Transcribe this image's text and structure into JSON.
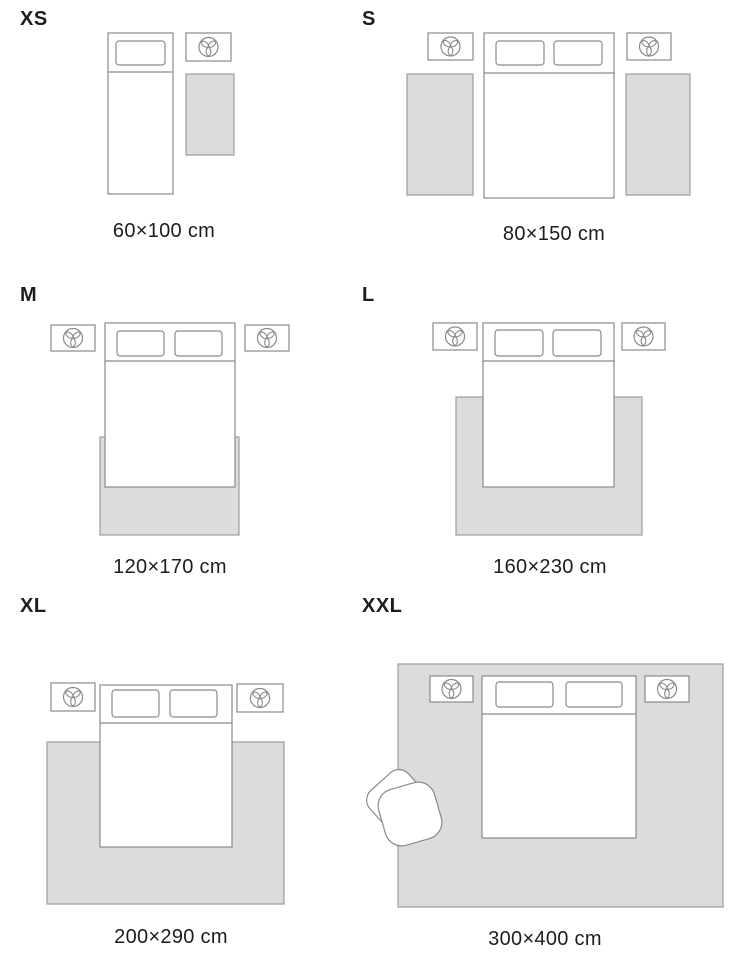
{
  "title": "Rug size guide",
  "colors": {
    "background": "#ffffff",
    "rug_fill": "#dcdcdc",
    "rug_stroke": "#9c9c9c",
    "furniture_stroke": "#8a8a8a",
    "text": "#1d1d1f"
  },
  "icons": {
    "plant": "plant-top-view-icon",
    "armchair": "armchair-top-view"
  },
  "sizes": [
    {
      "id": "xs",
      "label": "XS",
      "dimensions": "60×100 cm"
    },
    {
      "id": "s",
      "label": "S",
      "dimensions": "80×150 cm"
    },
    {
      "id": "m",
      "label": "M",
      "dimensions": "120×170 cm"
    },
    {
      "id": "l",
      "label": "L",
      "dimensions": "160×230 cm"
    },
    {
      "id": "xl",
      "label": "XL",
      "dimensions": "200×290 cm"
    },
    {
      "id": "xxl",
      "label": "XXL",
      "dimensions": "300×400 cm"
    }
  ]
}
